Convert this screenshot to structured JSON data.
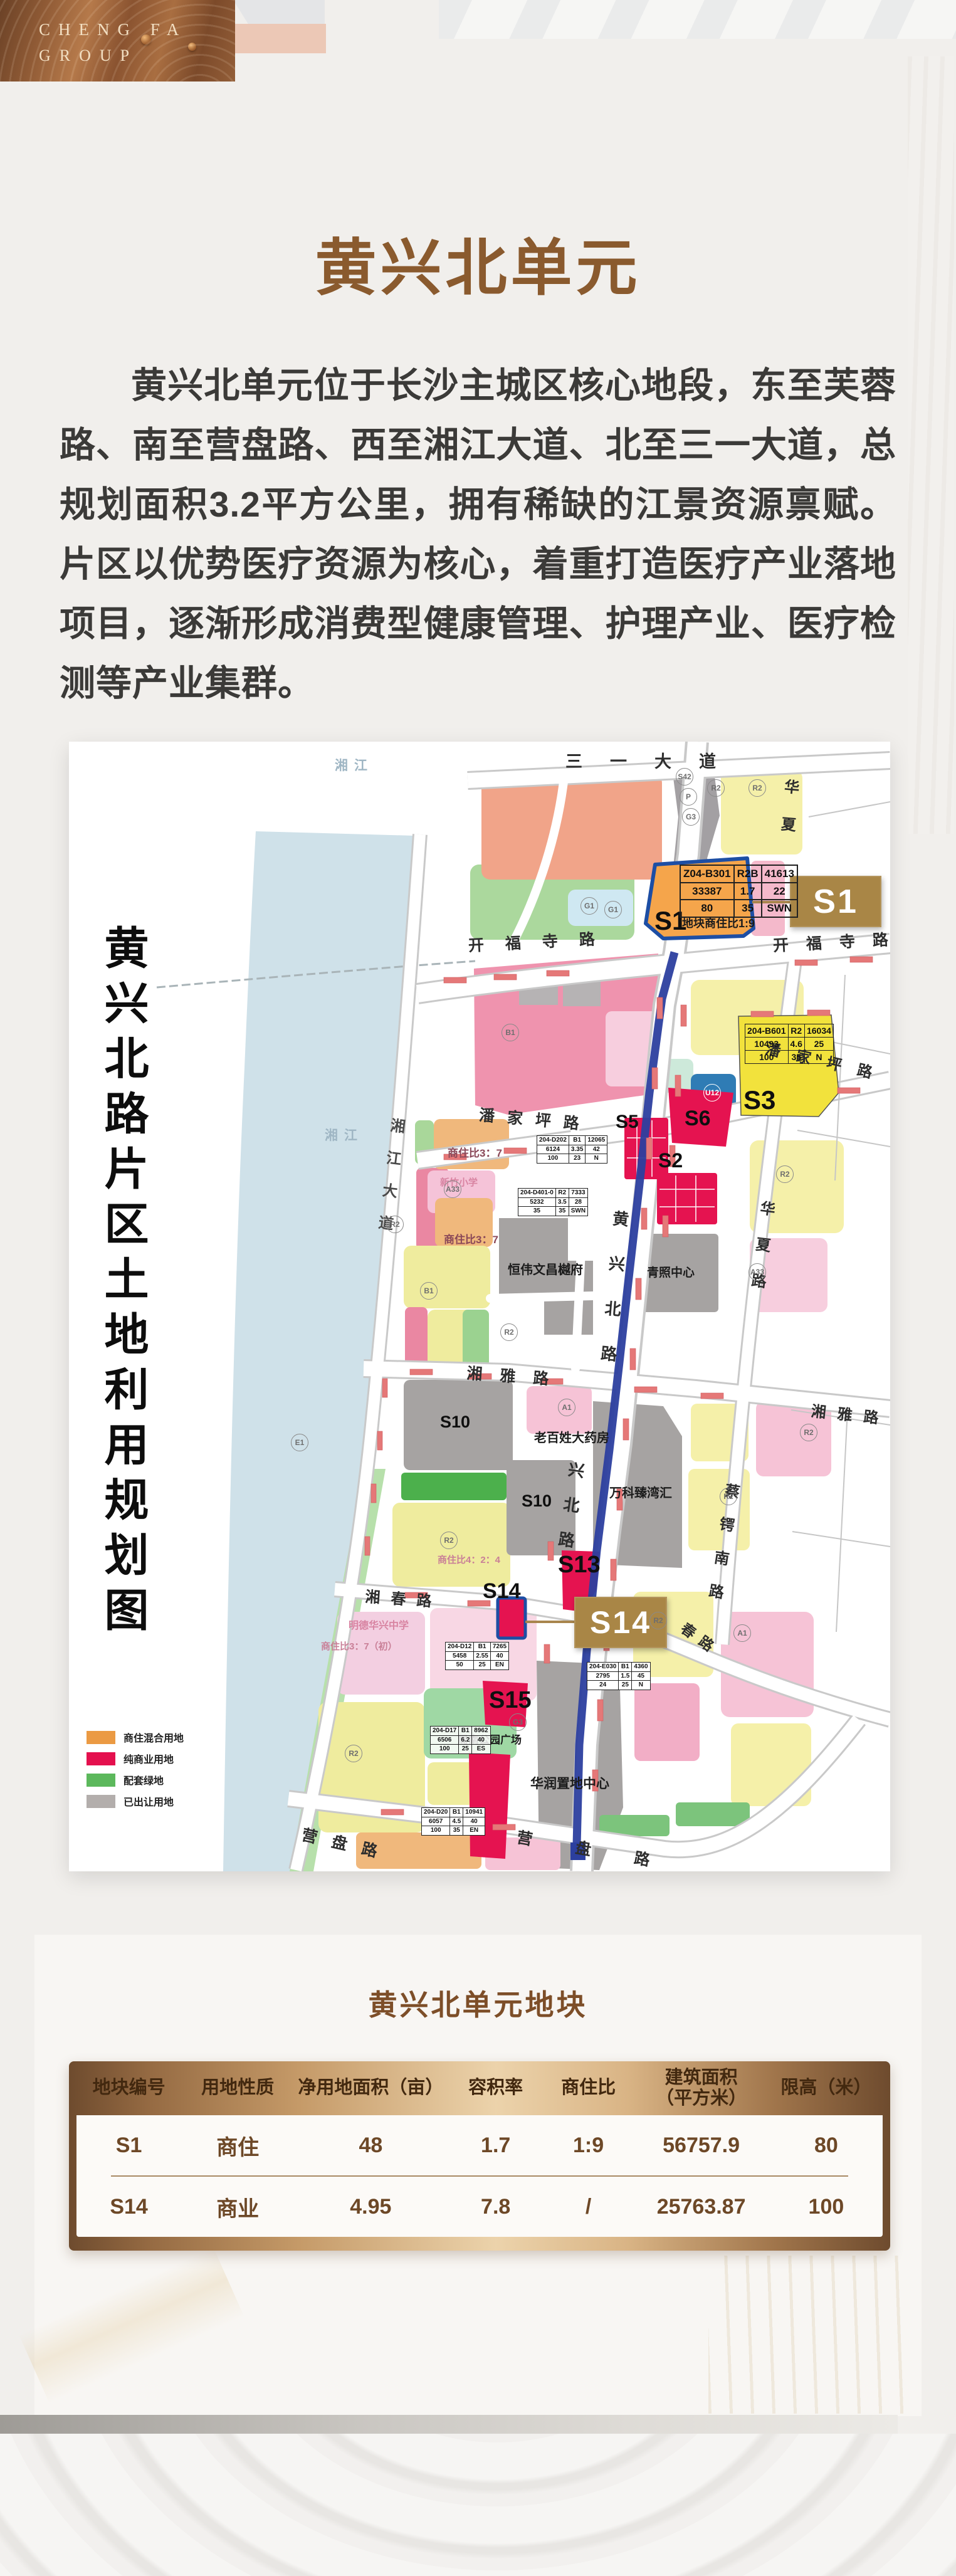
{
  "header": {
    "brand_line1": "CHENG FA",
    "brand_line2": "GROUP",
    "title": "黄兴北单元"
  },
  "intro": {
    "text": "黄兴北单元位于长沙主城区核心地段，东至芙蓉路、南至营盘路、西至湘江大道、北至三一大道，总规划面积3.2平方公里，拥有稀缺的江景资源禀赋。片区以优势医疗资源为核心，着重打造医疗产业落地项目，逐渐形成消费型健康管理、护理产业、医疗检测等产业集群。"
  },
  "map": {
    "title": "黄兴北路片区土地利用规划图",
    "water_label": "湘江",
    "roads": {
      "sanyi": "三一大道",
      "kaifusi_left": "开福寺路",
      "kaifusi_right": "开福寺路",
      "panjiaping_left": "潘家坪路",
      "panjiaping_right": "潘家坪路",
      "xiangya_left": "湘雅路",
      "xiangya_right": "湘雅路",
      "xiangchun": "湘春路",
      "chunlu": "春路",
      "yingpan_left": "营盘路",
      "yingpan_right": "营盘路",
      "huangxing": "黄兴北路",
      "xingbei": "兴北路",
      "riverside": "湘江大道",
      "huaxia": "华夏路",
      "huaxia_n": "华夏",
      "caie": "蔡锷南路"
    },
    "parcels": {
      "s1": "S1",
      "s2": "S2",
      "s3": "S3",
      "s5": "S5",
      "s6": "S6",
      "s10a": "S10",
      "s10b": "S10",
      "s13": "S13",
      "s14": "S14",
      "s15": "S15"
    },
    "badges": {
      "s1": "S1",
      "s14": "S14"
    },
    "notes": {
      "s1_ratio": "地块商住比1:9",
      "ratio37_a": "商住比3：7",
      "ratio37_b": "商住比3：7",
      "ratio37_c": "商住比3：7（初）",
      "ratio424": "商住比4：2：4"
    },
    "landmarks": {
      "hengwei": "恒伟文昌樾府",
      "qingzhao": "青照中心",
      "laobaixing": "老百姓大药房",
      "vanke": "万科臻湾汇",
      "huarun": "华润置地中心",
      "zhounan": "周南公园广场",
      "mingde": "明德华兴中学",
      "xinzhu": "新竹小学"
    },
    "codes": [
      "S42",
      "P",
      "G3",
      "R2",
      "R2",
      "G1",
      "G1",
      "B1",
      "R2",
      "B1",
      "R2",
      "R2",
      "E1",
      "U12",
      "G3",
      "A33",
      "R2",
      "A1",
      "A33",
      "R2",
      "R2",
      "A1",
      "R2",
      "R2"
    ],
    "tables": {
      "s1": [
        [
          "Z04-B301",
          "R2B",
          "41613"
        ],
        [
          "33387",
          "1.7",
          "22"
        ],
        [
          "80",
          "35",
          "SWN"
        ]
      ],
      "s3": [
        [
          "204-B601",
          "R2",
          "16034"
        ],
        [
          "10493",
          "4.6",
          "25"
        ],
        [
          "100",
          "35",
          "N"
        ]
      ],
      "d202": [
        [
          "204-D202",
          "B1",
          "12065"
        ],
        [
          "6124",
          "3.35",
          "42"
        ],
        [
          "100",
          "23",
          "N"
        ]
      ],
      "d401": [
        [
          "204-D401-0",
          "R2",
          "7333"
        ],
        [
          "5232",
          "3.5",
          "28"
        ],
        [
          "35",
          "35",
          "SWN"
        ]
      ],
      "d12": [
        [
          "204-D12",
          "B1",
          "7265"
        ],
        [
          "5458",
          "2.55",
          "40"
        ],
        [
          "50",
          "25",
          "EN"
        ]
      ],
      "e030": [
        [
          "204-E030",
          "B1",
          "4360"
        ],
        [
          "2795",
          "1.5",
          "45"
        ],
        [
          "24",
          "25",
          "N"
        ]
      ],
      "d17": [
        [
          "204-D17",
          "B1",
          "8962"
        ],
        [
          "6506",
          "6.2",
          "40"
        ],
        [
          "100",
          "25",
          "ES"
        ]
      ],
      "d20": [
        [
          "204-D20",
          "B1",
          "10941"
        ],
        [
          "6057",
          "4.5",
          "40"
        ],
        [
          "100",
          "35",
          "EN"
        ]
      ]
    },
    "legend": [
      {
        "label": "商住混合用地",
        "color": "#eb9a43"
      },
      {
        "label": "纯商业用地",
        "color": "#e4104e"
      },
      {
        "label": "配套绿地",
        "color": "#5cb85c"
      },
      {
        "label": "已出让用地",
        "color": "#b3aeac"
      }
    ]
  },
  "parcels_table": {
    "title": "黄兴北单元地块",
    "columns": [
      "地块编号",
      "用地性质",
      "净用地面积（亩）",
      "容积率",
      "商住比",
      "建筑面积（平方米）",
      "限高（米）"
    ],
    "rows": [
      [
        "S1",
        "商住",
        "48",
        "1.7",
        "1:9",
        "56757.9",
        "80"
      ],
      [
        "S14",
        "商业",
        "4.95",
        "7.8",
        "/",
        "25763.87",
        "100"
      ]
    ]
  }
}
